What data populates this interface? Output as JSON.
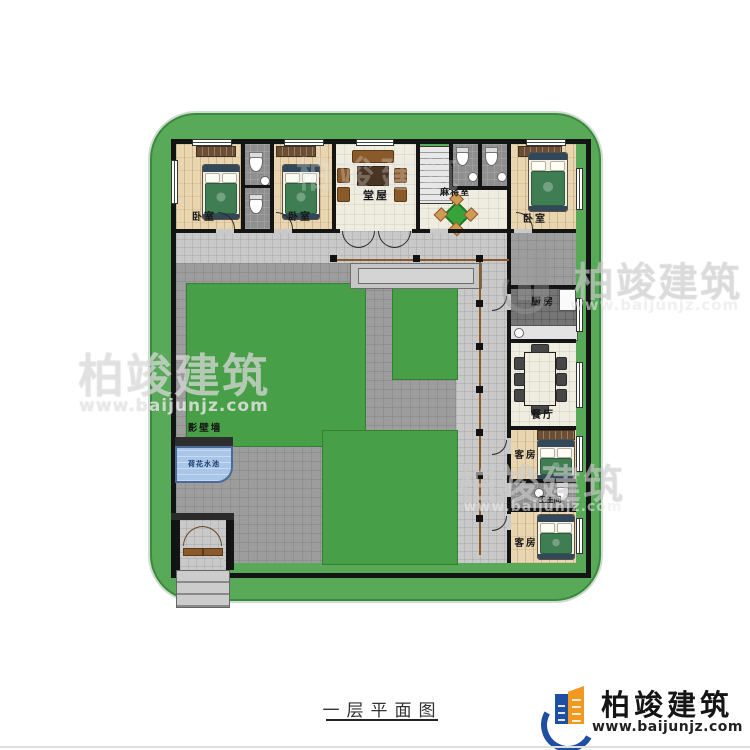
{
  "plan": {
    "title": "一层平面图",
    "rooms": {
      "bedroom_left": {
        "label": "卧室"
      },
      "bedroom_mid": {
        "label": "卧室"
      },
      "bedroom_right": {
        "label": "卧室"
      },
      "hall": {
        "label": "堂屋"
      },
      "mahjong": {
        "label": "麻将室"
      },
      "kitchen": {
        "label": "厨房"
      },
      "dining": {
        "label": "餐厅"
      },
      "guest_upper": {
        "label": "客房"
      },
      "bathroom": {
        "label": "卫生间"
      },
      "guest_lower": {
        "label": "客房"
      },
      "screen_wall": {
        "label": "影壁墙"
      },
      "lotus_pond": {
        "label": "荷花水池"
      }
    },
    "dimensions": {
      "top": {
        "total": "25000",
        "segments": [
          "4200",
          "1800",
          "3900",
          "5200",
          "2100",
          "1800",
          "1800",
          "4200"
        ]
      },
      "bottom": {
        "total": "25000",
        "segments": [
          "3365",
          "15635",
          "1500",
          "4500"
        ]
      },
      "left": {
        "total": "26000",
        "segments": [
          "5400",
          "3500",
          "3300",
          "3600",
          "3300",
          "1500",
          "1500",
          "3900"
        ]
      },
      "right": {
        "total": "26000",
        "segments": [
          "5400",
          "3500",
          "3300",
          "2700",
          "2700",
          "3300",
          "1800",
          "3300"
        ]
      }
    }
  },
  "watermark": {
    "main": "柏竣建筑",
    "sub": "www.baijunjz.com"
  },
  "brand": {
    "name": "柏竣建筑",
    "website": "www.baijunjz.com"
  },
  "colors": {
    "site_green": "#58aa58",
    "lawn_green": "#47a047",
    "path_gray": "#9d9d9d",
    "wall_black": "#141414",
    "pond_blue": "#a9c6e8",
    "wood_floor": "#e9d6b0",
    "brand_blue": "#1f4fa0",
    "brand_orange": "#f29a1f"
  }
}
